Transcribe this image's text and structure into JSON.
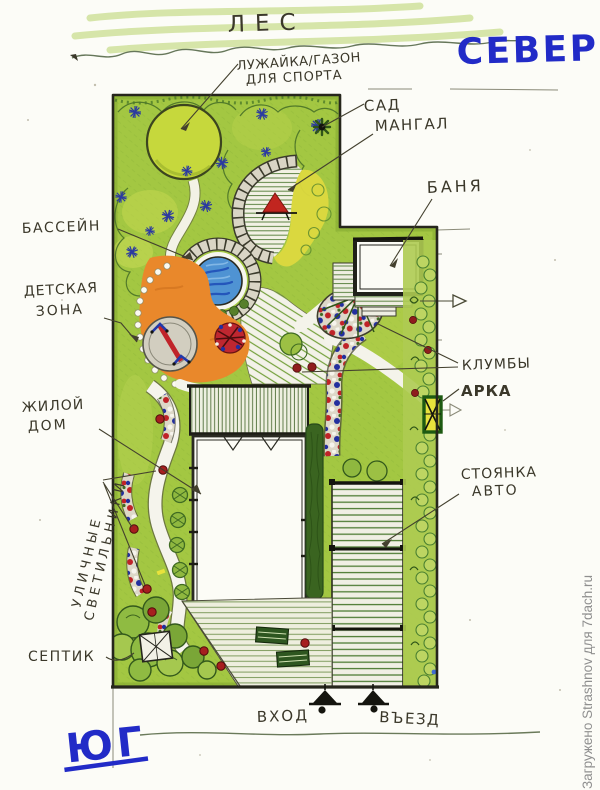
{
  "title": "Hand-drawn landscape plan of a garden plot",
  "compass": {
    "north": "СЕВЕР",
    "south": "ЮГ"
  },
  "surroundings": {
    "forest": "ЛЕС"
  },
  "entries": {
    "entrance": "ВХОД",
    "driveway": "ВЪЕЗД"
  },
  "labels": {
    "lawn_line1": "ЛУЖАЙКА/ГАЗОН",
    "lawn_line2": "ДЛЯ СПОРТА",
    "garden": "САД",
    "bbq": "МАНГАЛ",
    "bathhouse": "БАНЯ",
    "pool": "БАССЕЙН",
    "kids_line1": "ДЕТСКАЯ",
    "kids_line2": "ЗОНА",
    "flowerbeds": "КЛУМБЫ",
    "arch": "АРКА",
    "house_line1": "ЖИЛОЙ",
    "house_line2": "ДОМ",
    "parking_line1": "СТОЯНКА",
    "parking_line2": "АВТО",
    "lights_line1": "УЛИЧНЫЕ",
    "lights_line2": "СВЕТИЛЬНИКИ",
    "septic": "СЕПТИК"
  },
  "watermark": "Загружено Strashnov для 7dach.ru",
  "colors": {
    "paper": "#fcfcf7",
    "ink": "#3b382a",
    "blue_marker": "#222bc7",
    "grass": "#a3c742",
    "bright_lawn": "#c6d83c",
    "terrace_yellow": "#ddd93f",
    "kids_orange": "#e9882b",
    "pool_blue": "#4f93d3",
    "flower_red": "#bf2328",
    "flower_blue": "#232f9e",
    "stone_gray": "#d9d5c5",
    "hedge_dark_green": "#3a6420",
    "watermark_gray": "#8f8f8f"
  }
}
